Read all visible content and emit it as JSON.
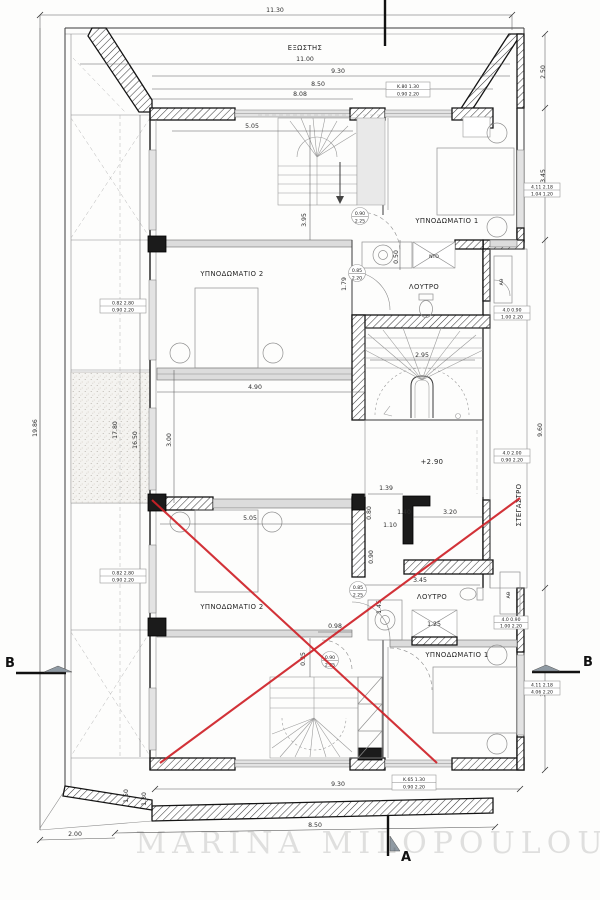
{
  "drawing": {
    "watermark": "MARINA MILOPOULOU",
    "level": "+2.90",
    "sections": {
      "a": "A",
      "b": "B"
    },
    "rooms": {
      "balcony": "ΕΞΩΣΤΗΣ",
      "bedroom1": "ΥΠΝΟΔΩΜΑΤΙΟ 1",
      "bedroom2": "ΥΠΝΟΔΩΜΑΤΙΟ 2",
      "bathroom": "ΛΟΥΤΡΟ",
      "canopy": "ΣΤΕΓΑΣΤΡΟ",
      "closet": "ΝΤΟ",
      "shaft": "ΑΘ"
    },
    "dims": {
      "top_overall": "11.30",
      "balcony_length": "11.00",
      "top_930": "9.30",
      "top_850": "8.50",
      "top_808": "8.08",
      "top_505": "5.05",
      "right_250": "2.50",
      "right_345_top": "3.45",
      "stair_395": "3.95",
      "sink_050": "0.50",
      "bath_179": "1.79",
      "mid_490": "4.90",
      "stair_295": "2.95",
      "left_1986": "19.86",
      "left_1780": "17.80",
      "left_1650": "16.50",
      "left_300": "3.00",
      "right_960": "9.60",
      "core_139": "1.39",
      "low_505": "5.05",
      "low_080": "0.80",
      "low_110": "1.10",
      "low_090": "0.90",
      "low_140": "1.40",
      "low_320": "3.20",
      "low_098": "0.98",
      "low_095": "0.95",
      "bath2_345": "3.45",
      "bath2_145": "1.45",
      "shower_125": "1.25",
      "right_345_bot": "3.45",
      "bot_930": "9.30",
      "bot_850": "8.50",
      "bot_200": "2.00",
      "bot_150": "1.50",
      "bot_130": "1.30"
    },
    "door_tags": {
      "t1": {
        "w": "0.90",
        "h": "2.25"
      },
      "t2": {
        "w": "0.85",
        "h": "2.20"
      },
      "t3": {
        "w": "0.85",
        "h": "2.25"
      },
      "t4": {
        "w": "0.90",
        "h": "2.25"
      }
    },
    "win_tags": {
      "tb1": {
        "top": "Κ.80  1.30",
        "bot": "0.90  2.20"
      },
      "tb2": {
        "top": "4.11  2.18",
        "bot": "1.04  1.20"
      },
      "tb3": {
        "top": "0.82  2.80",
        "bot": "0.90  2.20"
      },
      "tb4": {
        "top": "4.0  0.90",
        "bot": "1.00  2.20"
      },
      "tb5": {
        "top": "4.0  2.00",
        "bot": "0.90  2.20"
      },
      "tb6": {
        "top": "0.82  2.80",
        "bot": "0.90  2.20"
      },
      "tb7": {
        "top": "4.11  2.18",
        "bot": "4.06  2.20"
      },
      "tb8": {
        "top": "Κ.65  1.30",
        "bot": "0.90  2.20"
      }
    }
  }
}
